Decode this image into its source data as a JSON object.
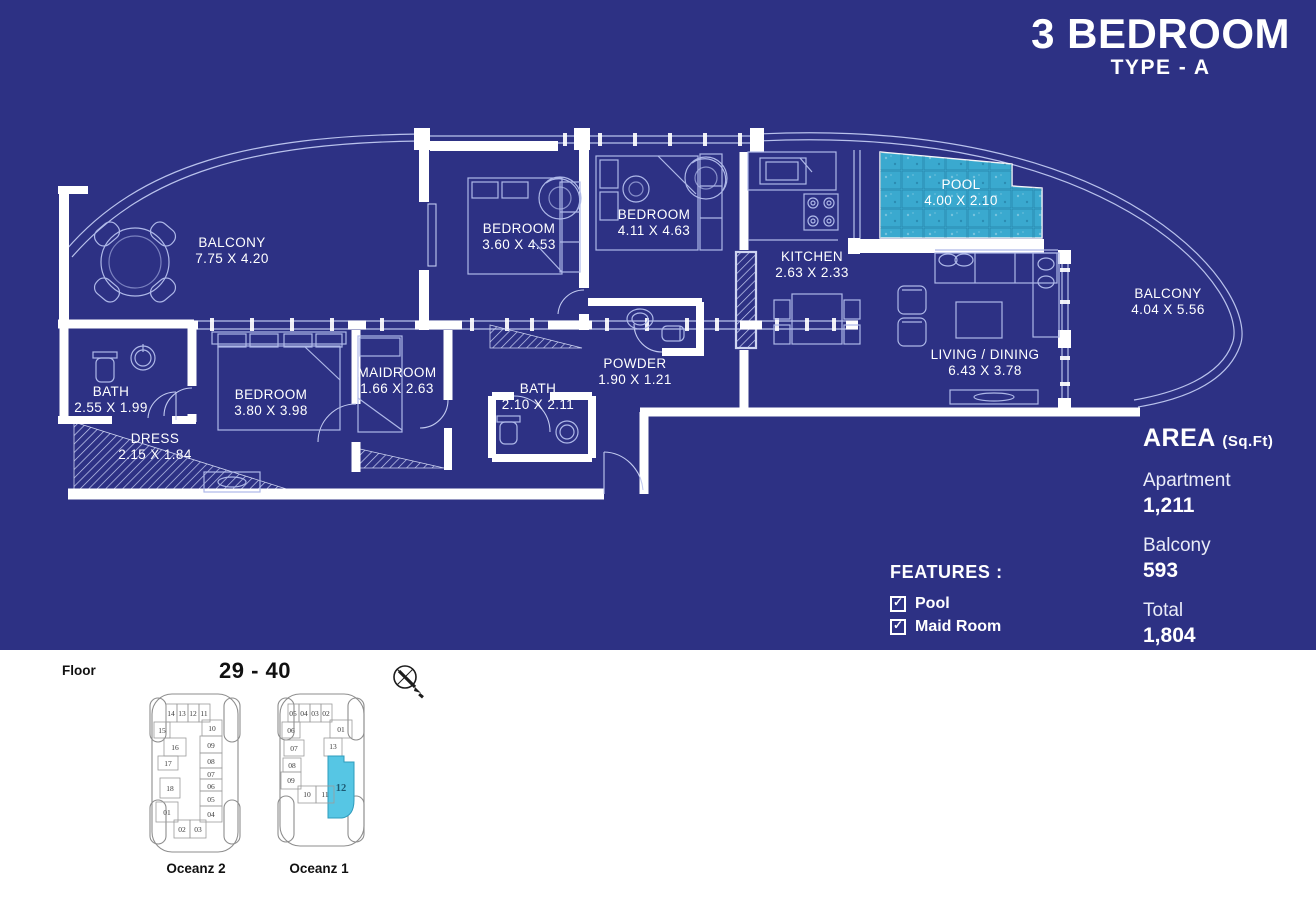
{
  "header": {
    "title": "3 BEDROOM",
    "subtitle": "TYPE - A"
  },
  "rooms": [
    {
      "name": "BALCONY",
      "dims": "7.75 X 4.20"
    },
    {
      "name": "BEDROOM",
      "dims": "3.60 X 4.53"
    },
    {
      "name": "BEDROOM",
      "dims": "4.11 X 4.63"
    },
    {
      "name": "KITCHEN",
      "dims": "2.63 X 2.33"
    },
    {
      "name": "POOL",
      "dims": "4.00 X 2.10"
    },
    {
      "name": "BALCONY",
      "dims": "4.04 X 5.56"
    },
    {
      "name": "LIVING / DINING",
      "dims": "6.43 X 3.78"
    },
    {
      "name": "POWDER",
      "dims": "1.90 X 1.21"
    },
    {
      "name": "BATH",
      "dims": "2.10 X 2.11"
    },
    {
      "name": "MAIDROOM",
      "dims": "1.66 X 2.63"
    },
    {
      "name": "BEDROOM",
      "dims": "3.80 X 3.98"
    },
    {
      "name": "BATH",
      "dims": "2.55 X 1.99"
    },
    {
      "name": "DRESS",
      "dims": "2.15 X 1.84"
    }
  ],
  "area_panel": {
    "heading": "AREA",
    "unit_suffix": "(Sq.Ft)",
    "rows": [
      {
        "label": "Apartment",
        "value": "1,211"
      },
      {
        "label": "Balcony",
        "value": "593"
      },
      {
        "label": "Total",
        "value": "1,804"
      }
    ]
  },
  "features": {
    "heading": "FEATURES :",
    "items": [
      {
        "label": "Pool",
        "checked": true
      },
      {
        "label": "Maid Room",
        "checked": true
      }
    ]
  },
  "floor_selector": {
    "label": "Floor",
    "range": "29 - 40",
    "buildings": [
      {
        "name": "Oceanz 2",
        "units": [
          "14",
          "13",
          "12",
          "11",
          "15",
          "16",
          "17",
          "18",
          "01",
          "02",
          "03",
          "10",
          "09",
          "08",
          "07",
          "06",
          "05",
          "04"
        ]
      },
      {
        "name": "Oceanz 1",
        "units": [
          "05",
          "04",
          "03",
          "02",
          "01",
          "06",
          "07",
          "08",
          "09",
          "13",
          "10",
          "11"
        ],
        "highlighted_unit": "12"
      }
    ]
  },
  "colors": {
    "background": "#2d3184",
    "wall": "#ffffff",
    "line": "#b9c2ec",
    "pool_fill": "#3fb3d9",
    "highlight": "#56c6e4"
  }
}
